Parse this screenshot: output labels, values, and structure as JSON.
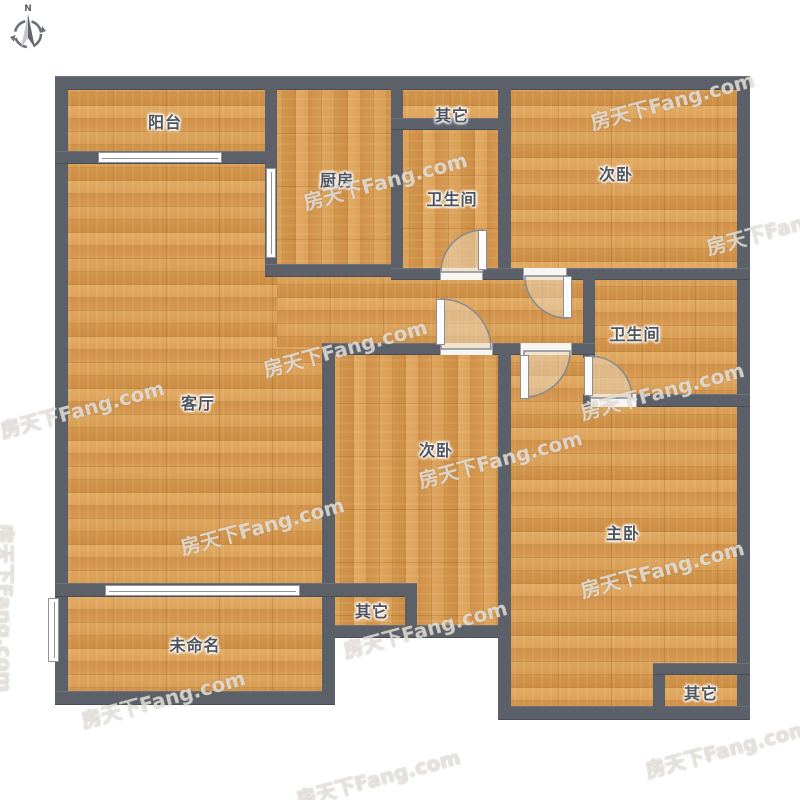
{
  "plan": {
    "kind": "residential-floor-plan",
    "colors": {
      "wall": "#5b6069",
      "floor": "#d89e55",
      "window": "#ffffff",
      "label_text": "#4e545e"
    }
  },
  "compass": {
    "north_label": "N"
  },
  "watermark": {
    "text": "房天下Fang.com"
  },
  "rooms": [
    {
      "id": "balcony",
      "label": "阳台"
    },
    {
      "id": "kitchen",
      "label": "厨房"
    },
    {
      "id": "other-top",
      "label": "其它"
    },
    {
      "id": "bathroom-top",
      "label": "卫生间"
    },
    {
      "id": "bedroom-top-right",
      "label": "次卧"
    },
    {
      "id": "bathroom-right",
      "label": "卫生间"
    },
    {
      "id": "living-room",
      "label": "客厅"
    },
    {
      "id": "bedroom-middle",
      "label": "次卧"
    },
    {
      "id": "master-bedroom",
      "label": "主卧"
    },
    {
      "id": "unnamed-room",
      "label": "未命名"
    },
    {
      "id": "other-bottom-middle",
      "label": "其它"
    },
    {
      "id": "other-bottom-right",
      "label": "其它"
    }
  ]
}
